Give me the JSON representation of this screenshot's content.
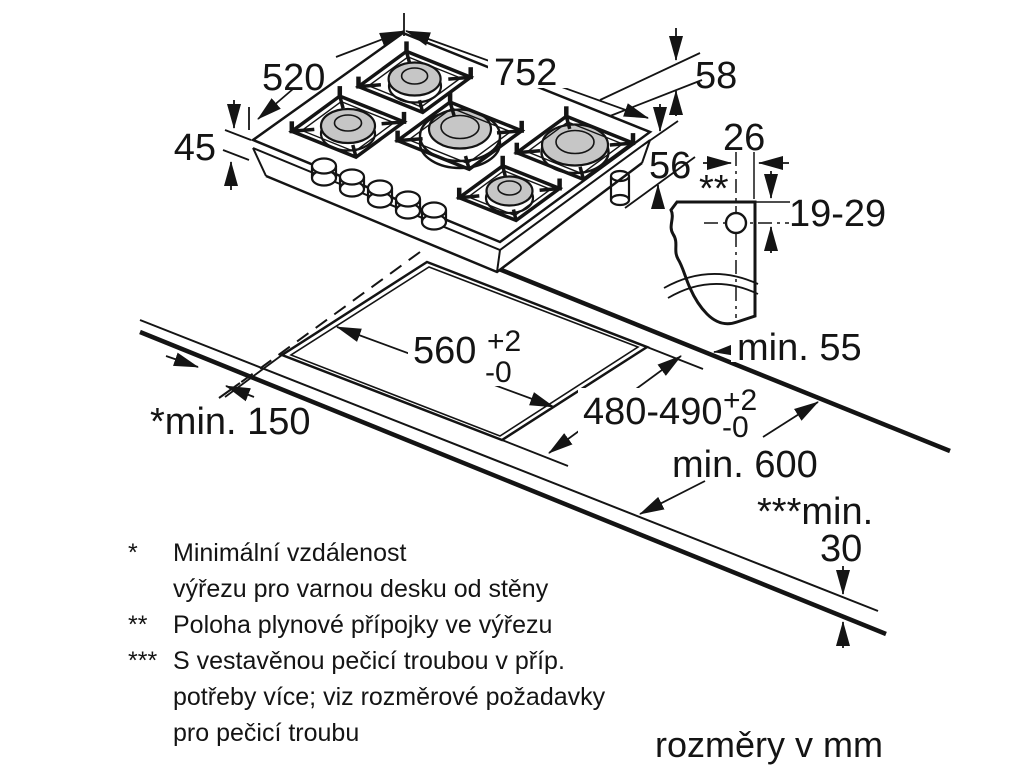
{
  "diagram": {
    "hob": {
      "width": "752",
      "depth": "520",
      "height": "45",
      "right_offset_top": "58",
      "right_offset_bottom": "56"
    },
    "gas": {
      "offset": "26",
      "marker": "**",
      "vertical_range": "19-29"
    },
    "cutout": {
      "width": "560",
      "width_plus": "+2",
      "width_minus": "-0",
      "depth": "480-490",
      "depth_plus": "+2",
      "depth_minus": "-0",
      "rear": "min. 55",
      "side": "*min. 150",
      "front_depth": "min. 600",
      "oven_line1": "***min.",
      "oven_line2": "30"
    },
    "footnotes": [
      {
        "marker": "*",
        "lines": [
          "Minimální vzdálenost",
          "výřezu pro varnou desku od stěny"
        ]
      },
      {
        "marker": "**",
        "lines": [
          "Poloha plynové přípojky ve výřezu"
        ]
      },
      {
        "marker": "***",
        "lines": [
          "S vestavěnou pečicí troubou v příp.",
          "potřeby více; viz rozměrové požadavky",
          "pro pečicí troubu"
        ]
      }
    ],
    "units": "rozměry v mm"
  }
}
